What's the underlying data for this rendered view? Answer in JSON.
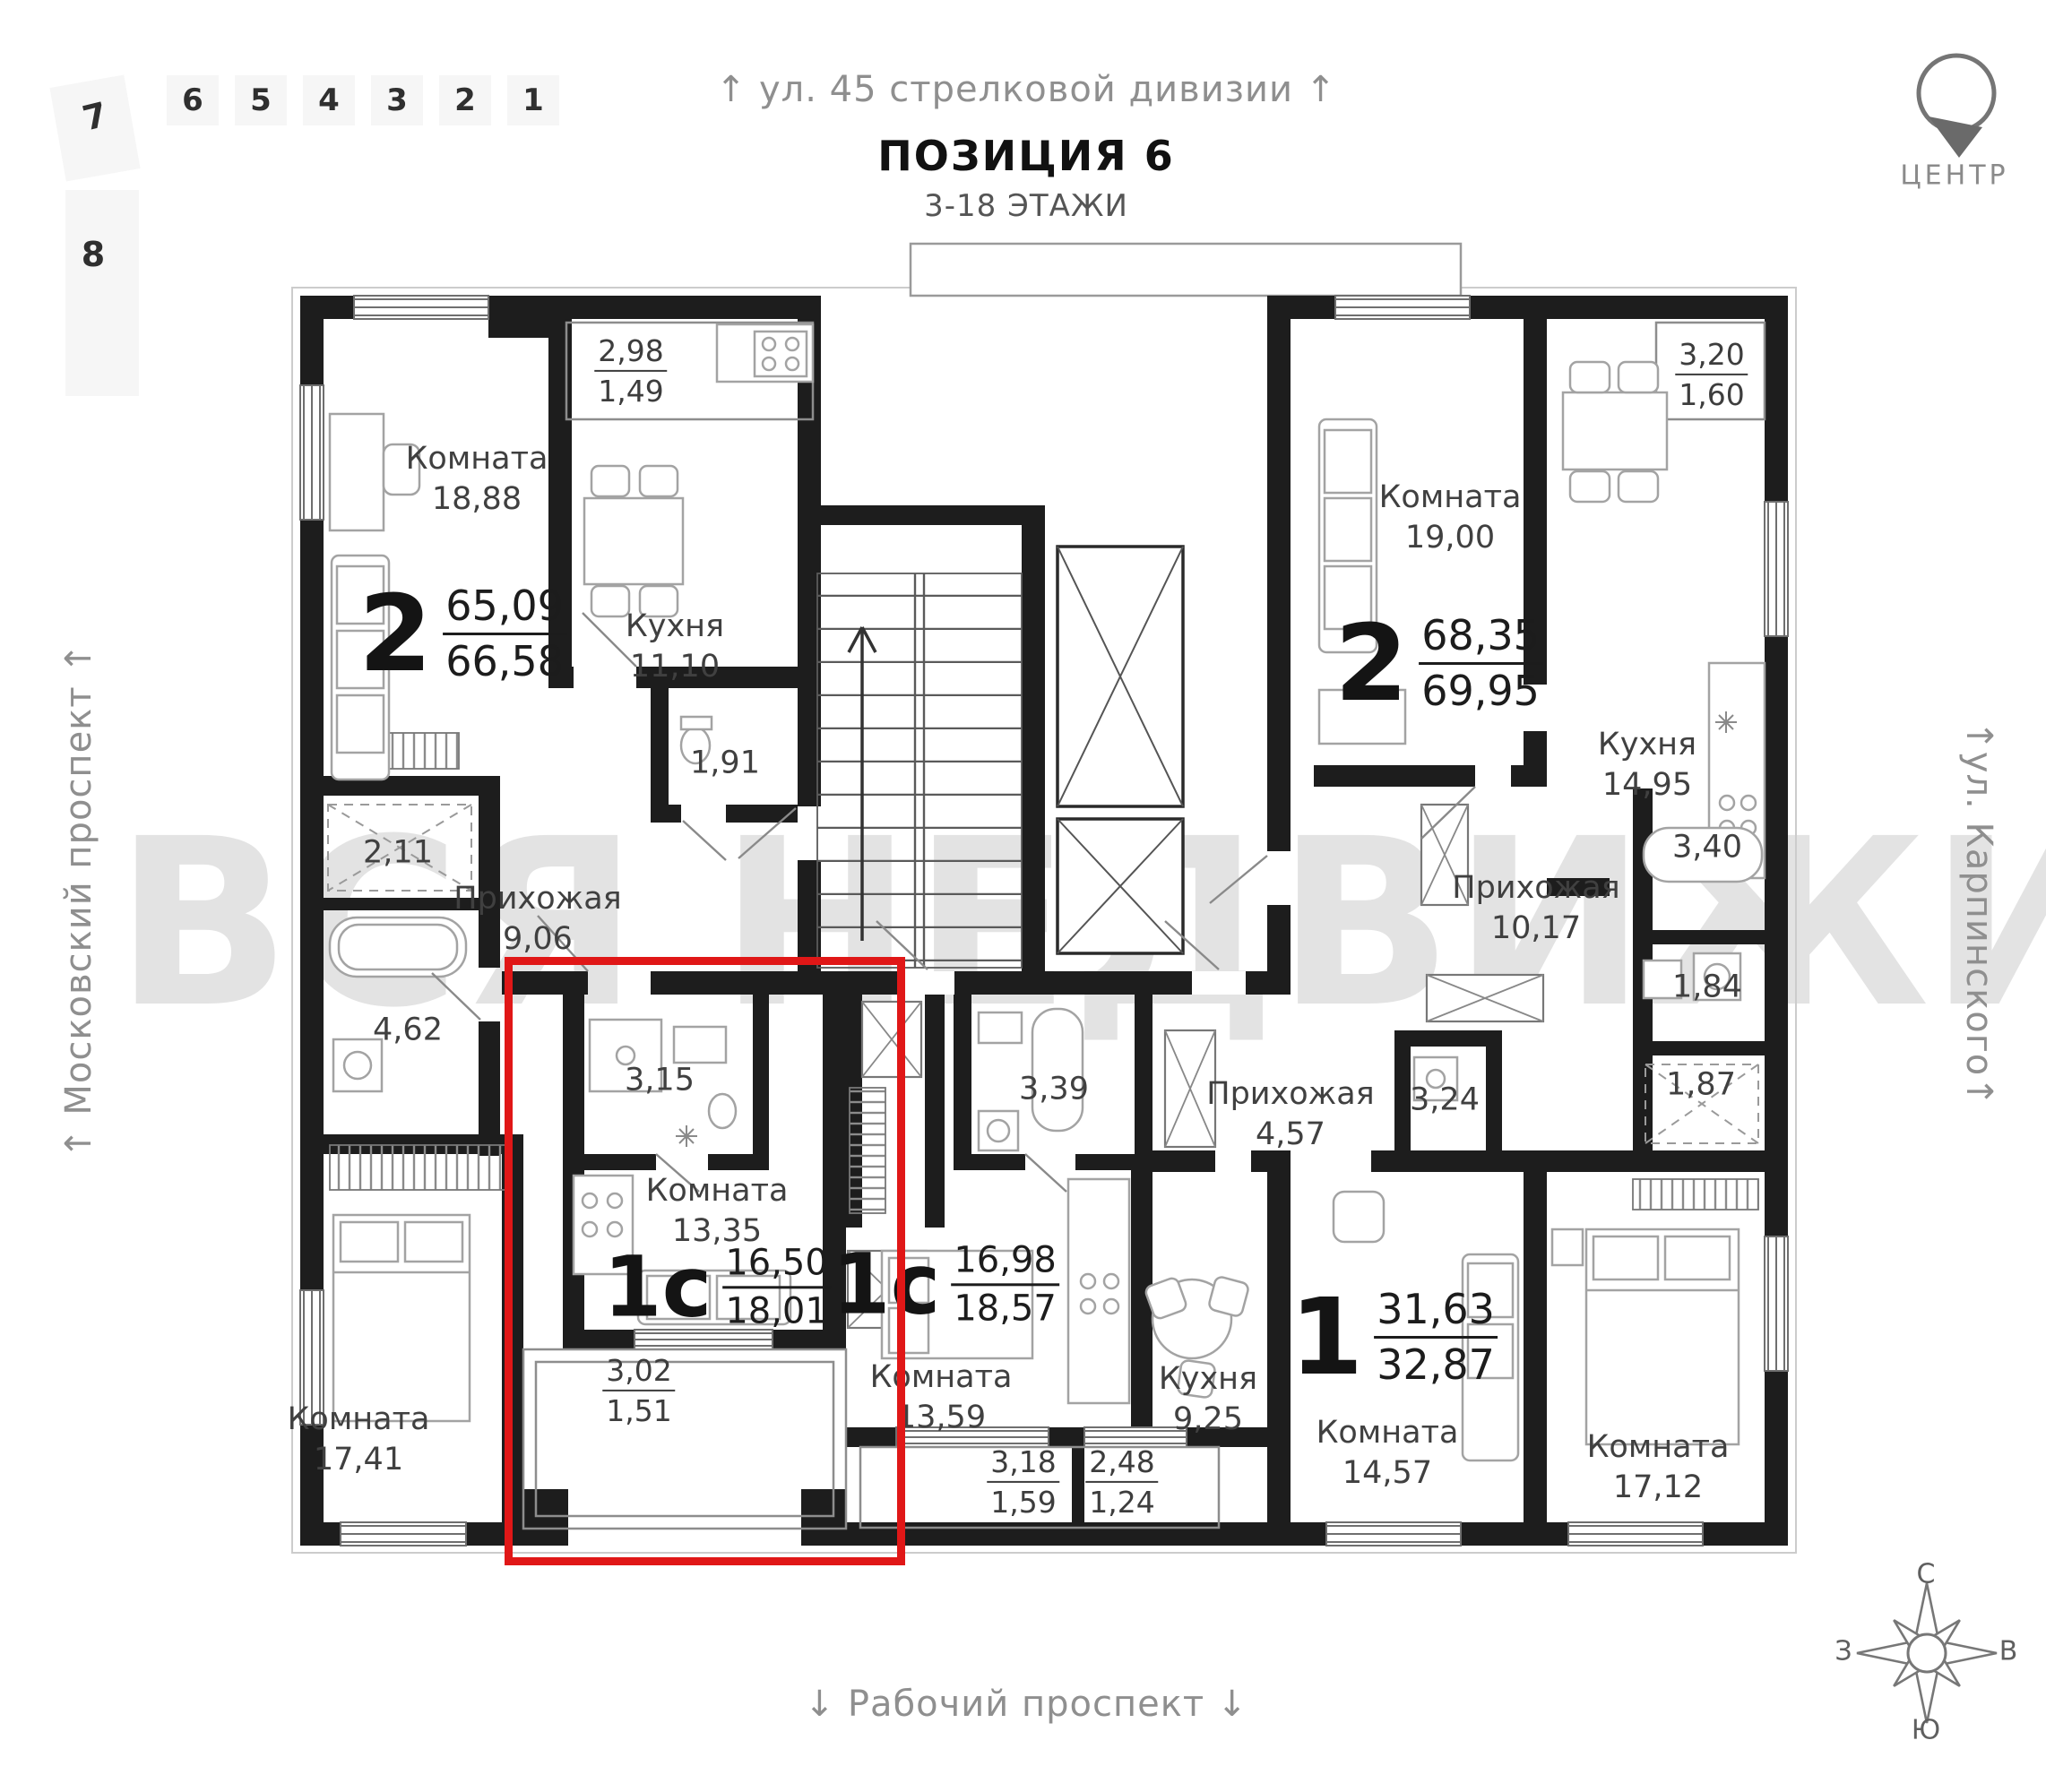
{
  "header": {
    "street_top": "↑ ул. 45 стрелковой дивизии ↑",
    "title": "ПОЗИЦИЯ 6",
    "subtitle": "3-18 ЭТАЖИ"
  },
  "margins": {
    "left_street": "↑ Московский проспект ↑",
    "right_street": "↑ул. Карпинского↑",
    "bottom_street": "↓ Рабочий проспект ↓"
  },
  "center_badge": {
    "label": "ЦЕНТР"
  },
  "floor_selector": {
    "tilted_item": "7",
    "lower_item": "8",
    "items": [
      "6",
      "5",
      "4",
      "3",
      "2",
      "1"
    ]
  },
  "compass": {
    "n": "С",
    "e": "В",
    "s": "Ю",
    "w": "З"
  },
  "watermark": "ВСЯ НЕДВИЖИМОСТЬ",
  "highlight_color": "#e01717",
  "apartments": [
    {
      "id": "left-2k",
      "type": "2",
      "area_top": "65,09",
      "area_bottom": "66,58",
      "rooms": [
        {
          "name": "Комната",
          "area": "18,88"
        },
        {
          "name": "Кухня",
          "area": "11,10"
        },
        {
          "name": "Прихожая",
          "area": "9,06"
        },
        {
          "name": "",
          "area": "1,91"
        },
        {
          "name": "",
          "area": "2,11"
        },
        {
          "name": "",
          "area": "4,62"
        },
        {
          "name": "Комната",
          "area": "17,41"
        }
      ],
      "balcony": {
        "top": "2,98",
        "bottom": "1,49"
      }
    },
    {
      "id": "studio-highlighted",
      "type": "1с",
      "area_top": "16,50",
      "area_bottom": "18,01",
      "rooms": [
        {
          "name": "",
          "area": "3,15"
        },
        {
          "name": "Комната",
          "area": "13,35"
        }
      ],
      "balcony": {
        "top": "3,02",
        "bottom": "1,51"
      }
    },
    {
      "id": "studio-center",
      "type": "1с",
      "area_top": "16,98",
      "area_bottom": "18,57",
      "rooms": [
        {
          "name": "",
          "area": "3,39"
        },
        {
          "name": "Комната",
          "area": "13,59"
        }
      ],
      "balcony": {
        "top": "3,18",
        "bottom": "1,59"
      }
    },
    {
      "id": "one-room",
      "type": "1",
      "area_top": "31,63",
      "area_bottom": "32,87",
      "rooms": [
        {
          "name": "Прихожая",
          "area": "4,57"
        },
        {
          "name": "",
          "area": "3,24"
        },
        {
          "name": "Кухня",
          "area": "9,25"
        },
        {
          "name": "Комната",
          "area": "14,57"
        }
      ],
      "balcony": {
        "top": "2,48",
        "bottom": "1,24"
      }
    },
    {
      "id": "right-2k",
      "type": "2",
      "area_top": "68,35",
      "area_bottom": "69,95",
      "rooms": [
        {
          "name": "Комната",
          "area": "19,00"
        },
        {
          "name": "Кухня",
          "area": "14,95"
        },
        {
          "name": "Прихожая",
          "area": "10,17"
        },
        {
          "name": "",
          "area": "3,40"
        },
        {
          "name": "",
          "area": "1,84"
        },
        {
          "name": "",
          "area": "1,87"
        },
        {
          "name": "Комната",
          "area": "17,12"
        }
      ],
      "balcony": {
        "top": "3,20",
        "bottom": "1,60"
      }
    }
  ]
}
